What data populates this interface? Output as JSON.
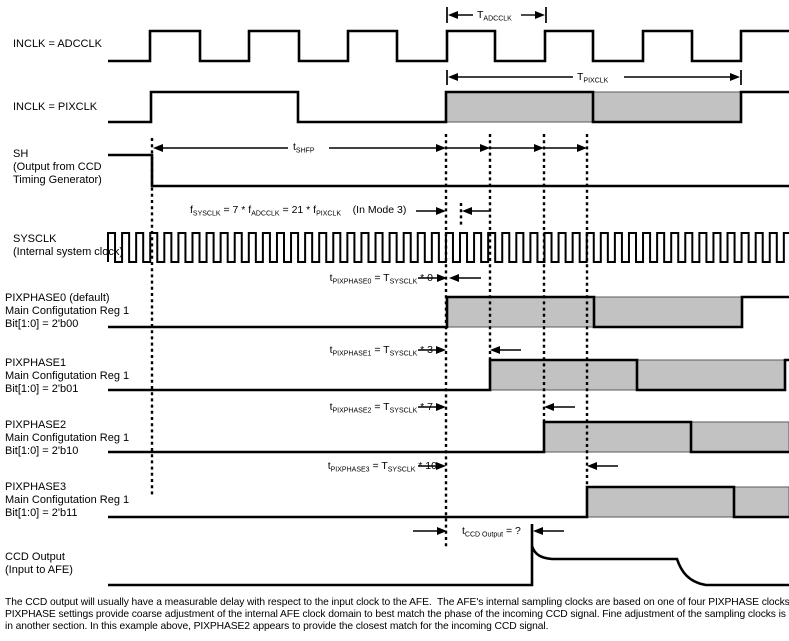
{
  "diagram": {
    "colors": {
      "line": "#000000",
      "shade_fill": "#c2c2c2",
      "shade_border": "#5a5a5a",
      "background": "#ffffff",
      "text": "#000000"
    },
    "canvas": {
      "width": 789,
      "height": 641
    },
    "signals": [
      {
        "id": "inclk-adcclk",
        "label_x": 13,
        "label_top": 38,
        "label_lines": [
          "INCLK = ADCCLK"
        ],
        "hi": 31,
        "lo": 61,
        "x0": 108,
        "x1": 789,
        "start": "lo",
        "edges": [
          150,
          200,
          249,
          299,
          348,
          397,
          447,
          495,
          545,
          593,
          643,
          692,
          741
        ],
        "shades": []
      },
      {
        "id": "inclk-pixclk",
        "label_x": 13,
        "label_top": 101,
        "label_lines": [
          "INCLK = PIXCLK"
        ],
        "hi": 92,
        "lo": 122,
        "x0": 108,
        "x1": 789,
        "start": "lo",
        "edges": [
          151,
          298,
          446,
          593,
          741
        ],
        "shades": [
          [
            446,
            741
          ]
        ]
      },
      {
        "id": "sh",
        "label_x": 13,
        "label_top": 148,
        "label_lines": [
          "SH",
          "(Output from CCD",
          "Timing Generator)"
        ],
        "hi": 155,
        "lo": 186,
        "x0": 108,
        "x1": 789,
        "start": "hi",
        "edges": [
          152
        ],
        "shades": []
      },
      {
        "id": "sysclk",
        "label_x": 13,
        "label_top": 233,
        "label_lines": [
          "SYSCLK",
          "(Internal system clock)"
        ],
        "hi": 233,
        "lo": 262,
        "x0": 108,
        "x1": 789,
        "start": "hi",
        "clock": {
          "half_period": 7.04
        },
        "shades": []
      },
      {
        "id": "pixphase0",
        "label_x": 5,
        "label_top": 292,
        "label_lines": [
          "PIXPHASE0 (default)",
          "Main Configutation Reg 1",
          "Bit[1:0] = 2'b00"
        ],
        "hi": 297,
        "lo": 327,
        "x0": 108,
        "x1": 789,
        "start": "lo",
        "edges": [
          447,
          594,
          742
        ],
        "shades": [
          [
            447,
            742
          ]
        ]
      },
      {
        "id": "pixphase1",
        "label_x": 5,
        "label_top": 357,
        "label_lines": [
          "PIXPHASE1",
          "Main Configutation Reg 1",
          "Bit[1:0] = 2'b01"
        ],
        "hi": 360,
        "lo": 390,
        "x0": 108,
        "x1": 789,
        "start": "lo",
        "edges": [
          490,
          637,
          785
        ],
        "shades": [
          [
            490,
            785
          ]
        ]
      },
      {
        "id": "pixphase2",
        "label_x": 5,
        "label_top": 419,
        "label_lines": [
          "PIXPHASE2",
          "Main Configutation Reg 1",
          "Bit[1:0] = 2'b10"
        ],
        "hi": 422,
        "lo": 452,
        "x0": 108,
        "x1": 789,
        "start": "lo",
        "edges": [
          544,
          691
        ],
        "shades": [
          [
            544,
            789
          ]
        ]
      },
      {
        "id": "pixphase3",
        "label_x": 5,
        "label_top": 481,
        "label_lines": [
          "PIXPHASE3",
          "Main Configutation Reg 1",
          "Bit[1:0] = 2'b11"
        ],
        "hi": 487,
        "lo": 517,
        "x0": 108,
        "x1": 789,
        "start": "lo",
        "edges": [
          587,
          734
        ],
        "shades": [
          [
            587,
            789
          ]
        ]
      },
      {
        "id": "ccd-output",
        "label_x": 5,
        "label_top": 551,
        "label_lines": [
          "CCD Output",
          "(Input to AFE)"
        ],
        "analog": true,
        "shades": []
      }
    ],
    "ccd": {
      "x0": 108,
      "x1": 789,
      "low": 585,
      "rise_x": 532,
      "ext_top": 524,
      "peak": 546,
      "plateau": 559,
      "plateau_x0": 552,
      "plateau_x1": 677,
      "settle_x": 706
    },
    "dashed_lines": [
      {
        "x": 152,
        "y0": 138,
        "y1": 496
      },
      {
        "x": 446,
        "y0": 134,
        "y1": 547
      },
      {
        "x": 461,
        "y0": 203,
        "y1": 225
      },
      {
        "x": 490,
        "y0": 134,
        "y1": 359
      },
      {
        "x": 544,
        "y0": 134,
        "y1": 421
      },
      {
        "x": 587,
        "y0": 134,
        "y1": 486
      }
    ],
    "dims": [
      {
        "id": "dim-t-adcclk",
        "y": 15,
        "x0": 447,
        "x1": 546,
        "tick_y0": 7,
        "tick_y1": 23,
        "gap": [
          473,
          521
        ],
        "label_parts": [
          {
            "t": "T"
          },
          {
            "s": "ADCCLK"
          }
        ],
        "label_left": 477,
        "label_top": 8
      },
      {
        "id": "dim-t-pixclk",
        "y": 77,
        "x0": 447,
        "x1": 741,
        "tick_y0": 70,
        "tick_y1": 85,
        "gap": [
          573,
          624
        ],
        "label_parts": [
          {
            "t": "T"
          },
          {
            "s": "PIXCLK"
          }
        ],
        "label_left": 577,
        "label_top": 70
      }
    ],
    "shfp": {
      "y": 148,
      "x0": 153,
      "x1": 446,
      "gap": [
        288,
        329
      ],
      "label_parts": [
        {
          "t": "t"
        },
        {
          "s": "SHFP"
        }
      ],
      "label_left": 293,
      "label_top": 140,
      "chain": [
        490,
        544,
        587
      ]
    },
    "annotations": [
      {
        "id": "f-sysclk-formula",
        "text_parts": [
          {
            "t": "f"
          },
          {
            "s": "SYSCLK"
          },
          {
            "t": " = 7 * f"
          },
          {
            "s": "ADCCLK"
          },
          {
            "t": " = 21 * f"
          },
          {
            "s": "PIXCLK"
          },
          {
            "t": "    (In Mode 3)"
          }
        ],
        "left": 190,
        "top": 203,
        "arrow_y": 211,
        "right_arrow": [
          416,
          446
        ],
        "left_arrow": [
          462,
          491
        ]
      },
      {
        "id": "t-pixphase0",
        "text_parts": [
          {
            "t": "t"
          },
          {
            "s": "PIXPHASE0"
          },
          {
            "t": " = T"
          },
          {
            "s": "SYSCLK"
          },
          {
            "t": " * 0"
          }
        ],
        "right": 433,
        "top": 271,
        "arrow_y": 278,
        "right_arrow": [
          418,
          447
        ],
        "left_arrow": [
          449,
          481
        ]
      },
      {
        "id": "t-pixphase1",
        "text_parts": [
          {
            "t": "t"
          },
          {
            "s": "PIXPHASE1"
          },
          {
            "t": " = T"
          },
          {
            "s": "SYSCLK"
          },
          {
            "t": " * 3"
          }
        ],
        "right": 433,
        "top": 343,
        "arrow_y": 350,
        "right_arrow": [
          418,
          446
        ],
        "left_arrow": [
          490,
          521
        ]
      },
      {
        "id": "t-pixphase2",
        "text_parts": [
          {
            "t": "t"
          },
          {
            "s": "PIXPHASE2"
          },
          {
            "t": " = T"
          },
          {
            "s": "SYSCLK"
          },
          {
            "t": " * 7"
          }
        ],
        "right": 433,
        "top": 400,
        "arrow_y": 407,
        "right_arrow": [
          418,
          446
        ],
        "left_arrow": [
          544,
          575
        ]
      },
      {
        "id": "t-pixphase3",
        "text_parts": [
          {
            "t": "t"
          },
          {
            "s": "PIXPHASE3"
          },
          {
            "t": " = T"
          },
          {
            "s": "SYSCLK"
          },
          {
            "t": " * 10"
          }
        ],
        "right": 437,
        "top": 459,
        "arrow_y": 466,
        "right_arrow": [
          418,
          446
        ],
        "left_arrow": [
          587,
          618
        ]
      },
      {
        "id": "t-ccd-output",
        "text_parts": [
          {
            "t": "t"
          },
          {
            "s": "CCD Output"
          },
          {
            "t": " = ?"
          }
        ],
        "left": 462,
        "top": 524,
        "arrow_y": 531,
        "right_arrow": [
          413,
          447
        ],
        "left_arrow": [
          533,
          564
        ]
      }
    ],
    "footnote_lines": [
      "The CCD output will usually have a measurable delay with respect to the input clock to the AFE.  The AFE's internal sampling clocks are based on one of four PIXPHASE clocks.  These",
      "PIXPHASE settings provide coarse adjustment of the internal AFE clock domain to best match the phase of the incoming CCD signal. Fine adjustment of the sampling clocks is discussed",
      "in another section. In this example above, PIXPHASE2 appears to provide the closest match for the incoming CCD signal."
    ]
  }
}
